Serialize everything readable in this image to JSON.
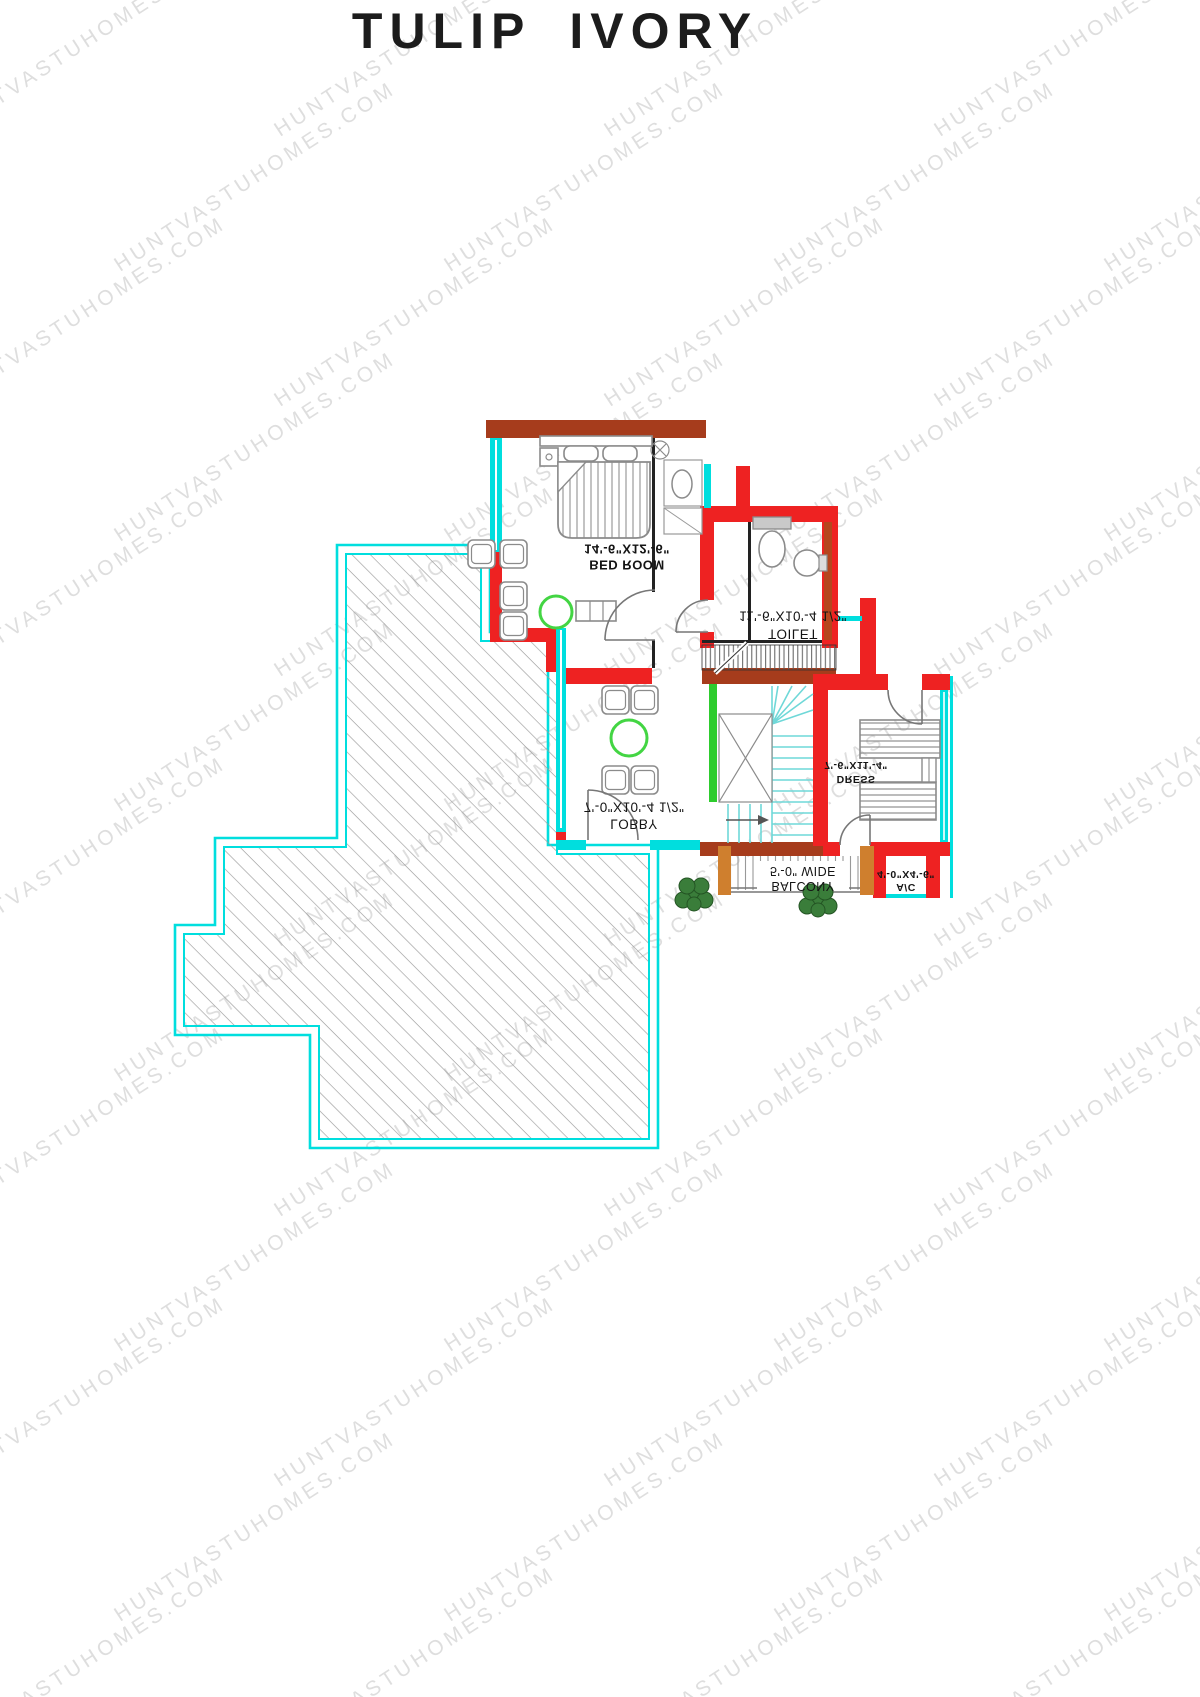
{
  "title": "TULIP IVORY",
  "watermark": {
    "text": "HUNTVASTUHOMES.COM"
  },
  "rooms": {
    "bedroom": {
      "dims": "14'-6\"X12'-6\"",
      "name": "BED ROOM"
    },
    "toilet": {
      "dims": "11'-6\"X10'-4 1/2\"",
      "name": "TOILET"
    },
    "lobby": {
      "dims": "7'-0\"X10'-4 1/2\"",
      "name": "LOBBY"
    },
    "dress": {
      "dims": "7'-6\"X11'-4\"",
      "name": "DRESS"
    },
    "balcony": {
      "dims": "5'-0\" WIDE",
      "name": "BALCONY"
    },
    "ac": {
      "dims": "4'-0\"X4'-6\"",
      "name": "A/C"
    }
  },
  "colors": {
    "wall-red": "#ee2222",
    "wall-brown": "#a63c1c",
    "wall-brown2": "#b5461e",
    "cyan": "#00dede",
    "stair-cyan": "#6fd8d8",
    "green": "#2ecc2e",
    "table-green": "#43d543",
    "orange": "#cf7f2e",
    "line": "#222222",
    "furn": "#8b8b8b",
    "hatch": "#9d9d9d",
    "watermark": "#cbcbcb",
    "title": "#1c1c1c",
    "plant": "#3a7d3a"
  }
}
